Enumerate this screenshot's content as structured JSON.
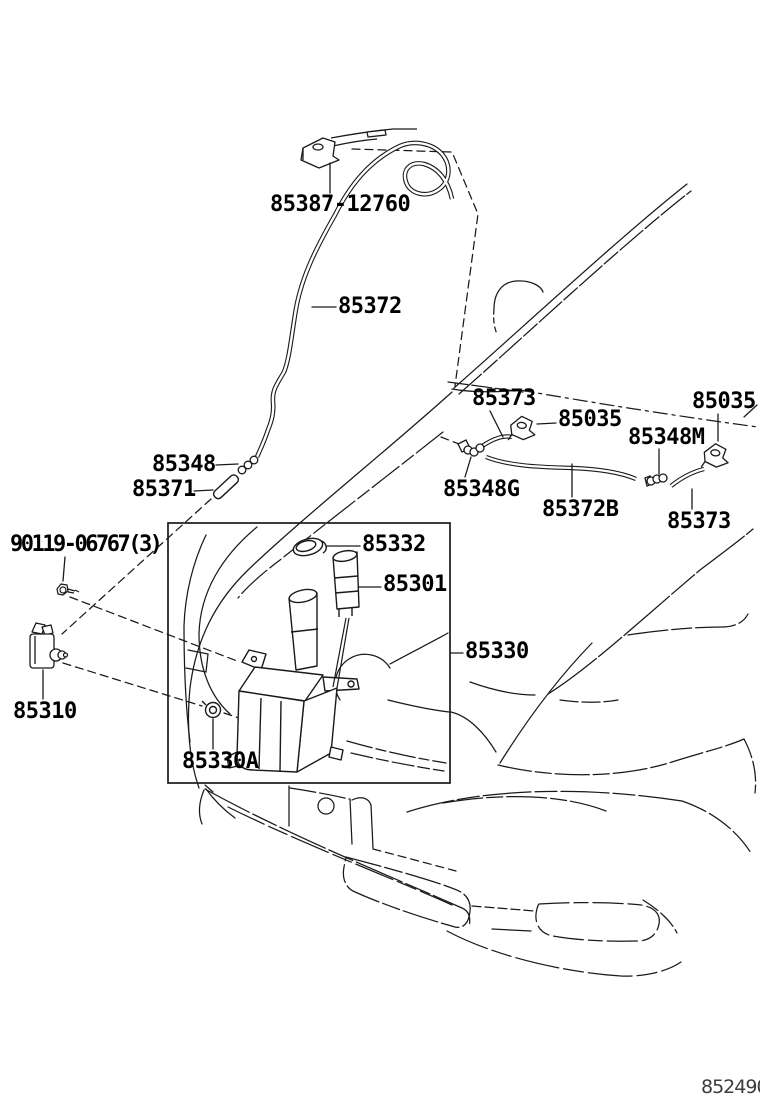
{
  "diagram": {
    "type": "parts-diagram",
    "subject": "windshield washer system, front of vehicle",
    "ink_color": "#1a1a1a",
    "background_color": "#ffffff"
  },
  "parts": {
    "hood_nozzle": "85387-12760",
    "hose_front": "85372",
    "hose_rear_left": "85373",
    "nozzle_rear_left": "85035",
    "joint_rear_mid": "85348M",
    "nozzle_rear_right": "85035",
    "joint_rear_left": "85348G",
    "hose_rear_mid": "85372B",
    "hose_rear_right": "85373",
    "joint_front": "85348",
    "hose_front_lower": "85371",
    "bolt": "90119-06767(3)",
    "cap": "85332",
    "pump_motor": "85301",
    "reservoir": "85330",
    "washer_pump": "85310",
    "grommet": "85330A"
  },
  "footer": {
    "code": "852490"
  }
}
